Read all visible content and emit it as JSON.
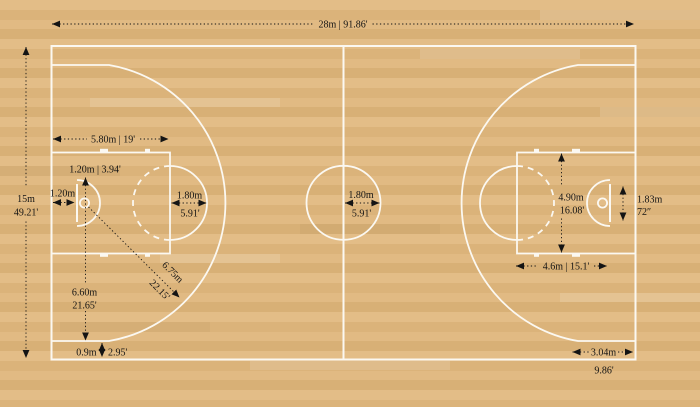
{
  "colors": {
    "floor": "#e0b982",
    "stripe1": "#e3bd87",
    "stripe2": "#dbb37a",
    "stripe3": "#e1ba83",
    "stripe4": "#d8b076",
    "line": "#fbf8f1",
    "ann": "#141414"
  },
  "ann": {
    "court_length": "28m | 91.86'",
    "court_width_m": "15m",
    "court_width_ft": "49.21'",
    "key_length": "5.80m | 19'",
    "no_charge_semicircle": "1.20m | 3.94'",
    "backboard_to_endline": "1.20m",
    "ft_circle_radius_m": "1.80m",
    "ft_circle_radius_ft": "5.91'",
    "center_circle_radius_m": "1.80m",
    "center_circle_radius_ft": "5.91'",
    "key_width_m": "4.90m",
    "key_width_ft": "16.08'",
    "backboard_width_m": "1.83m",
    "backboard_width_in": "72″",
    "ft_line_to_backboard": "4.6m | 15.1'",
    "three_point_radius_m": "6.75m",
    "three_point_radius_ft": "22.15'",
    "basket_to_three_point_m": "6.60m",
    "basket_to_three_point_ft": "21.65'",
    "three_point_sideline_offset_m": "0.9m",
    "three_point_sideline_offset_ft": "2.95'",
    "corner_three_length_m": "3.04m",
    "corner_three_length_ft": "9.86'"
  }
}
